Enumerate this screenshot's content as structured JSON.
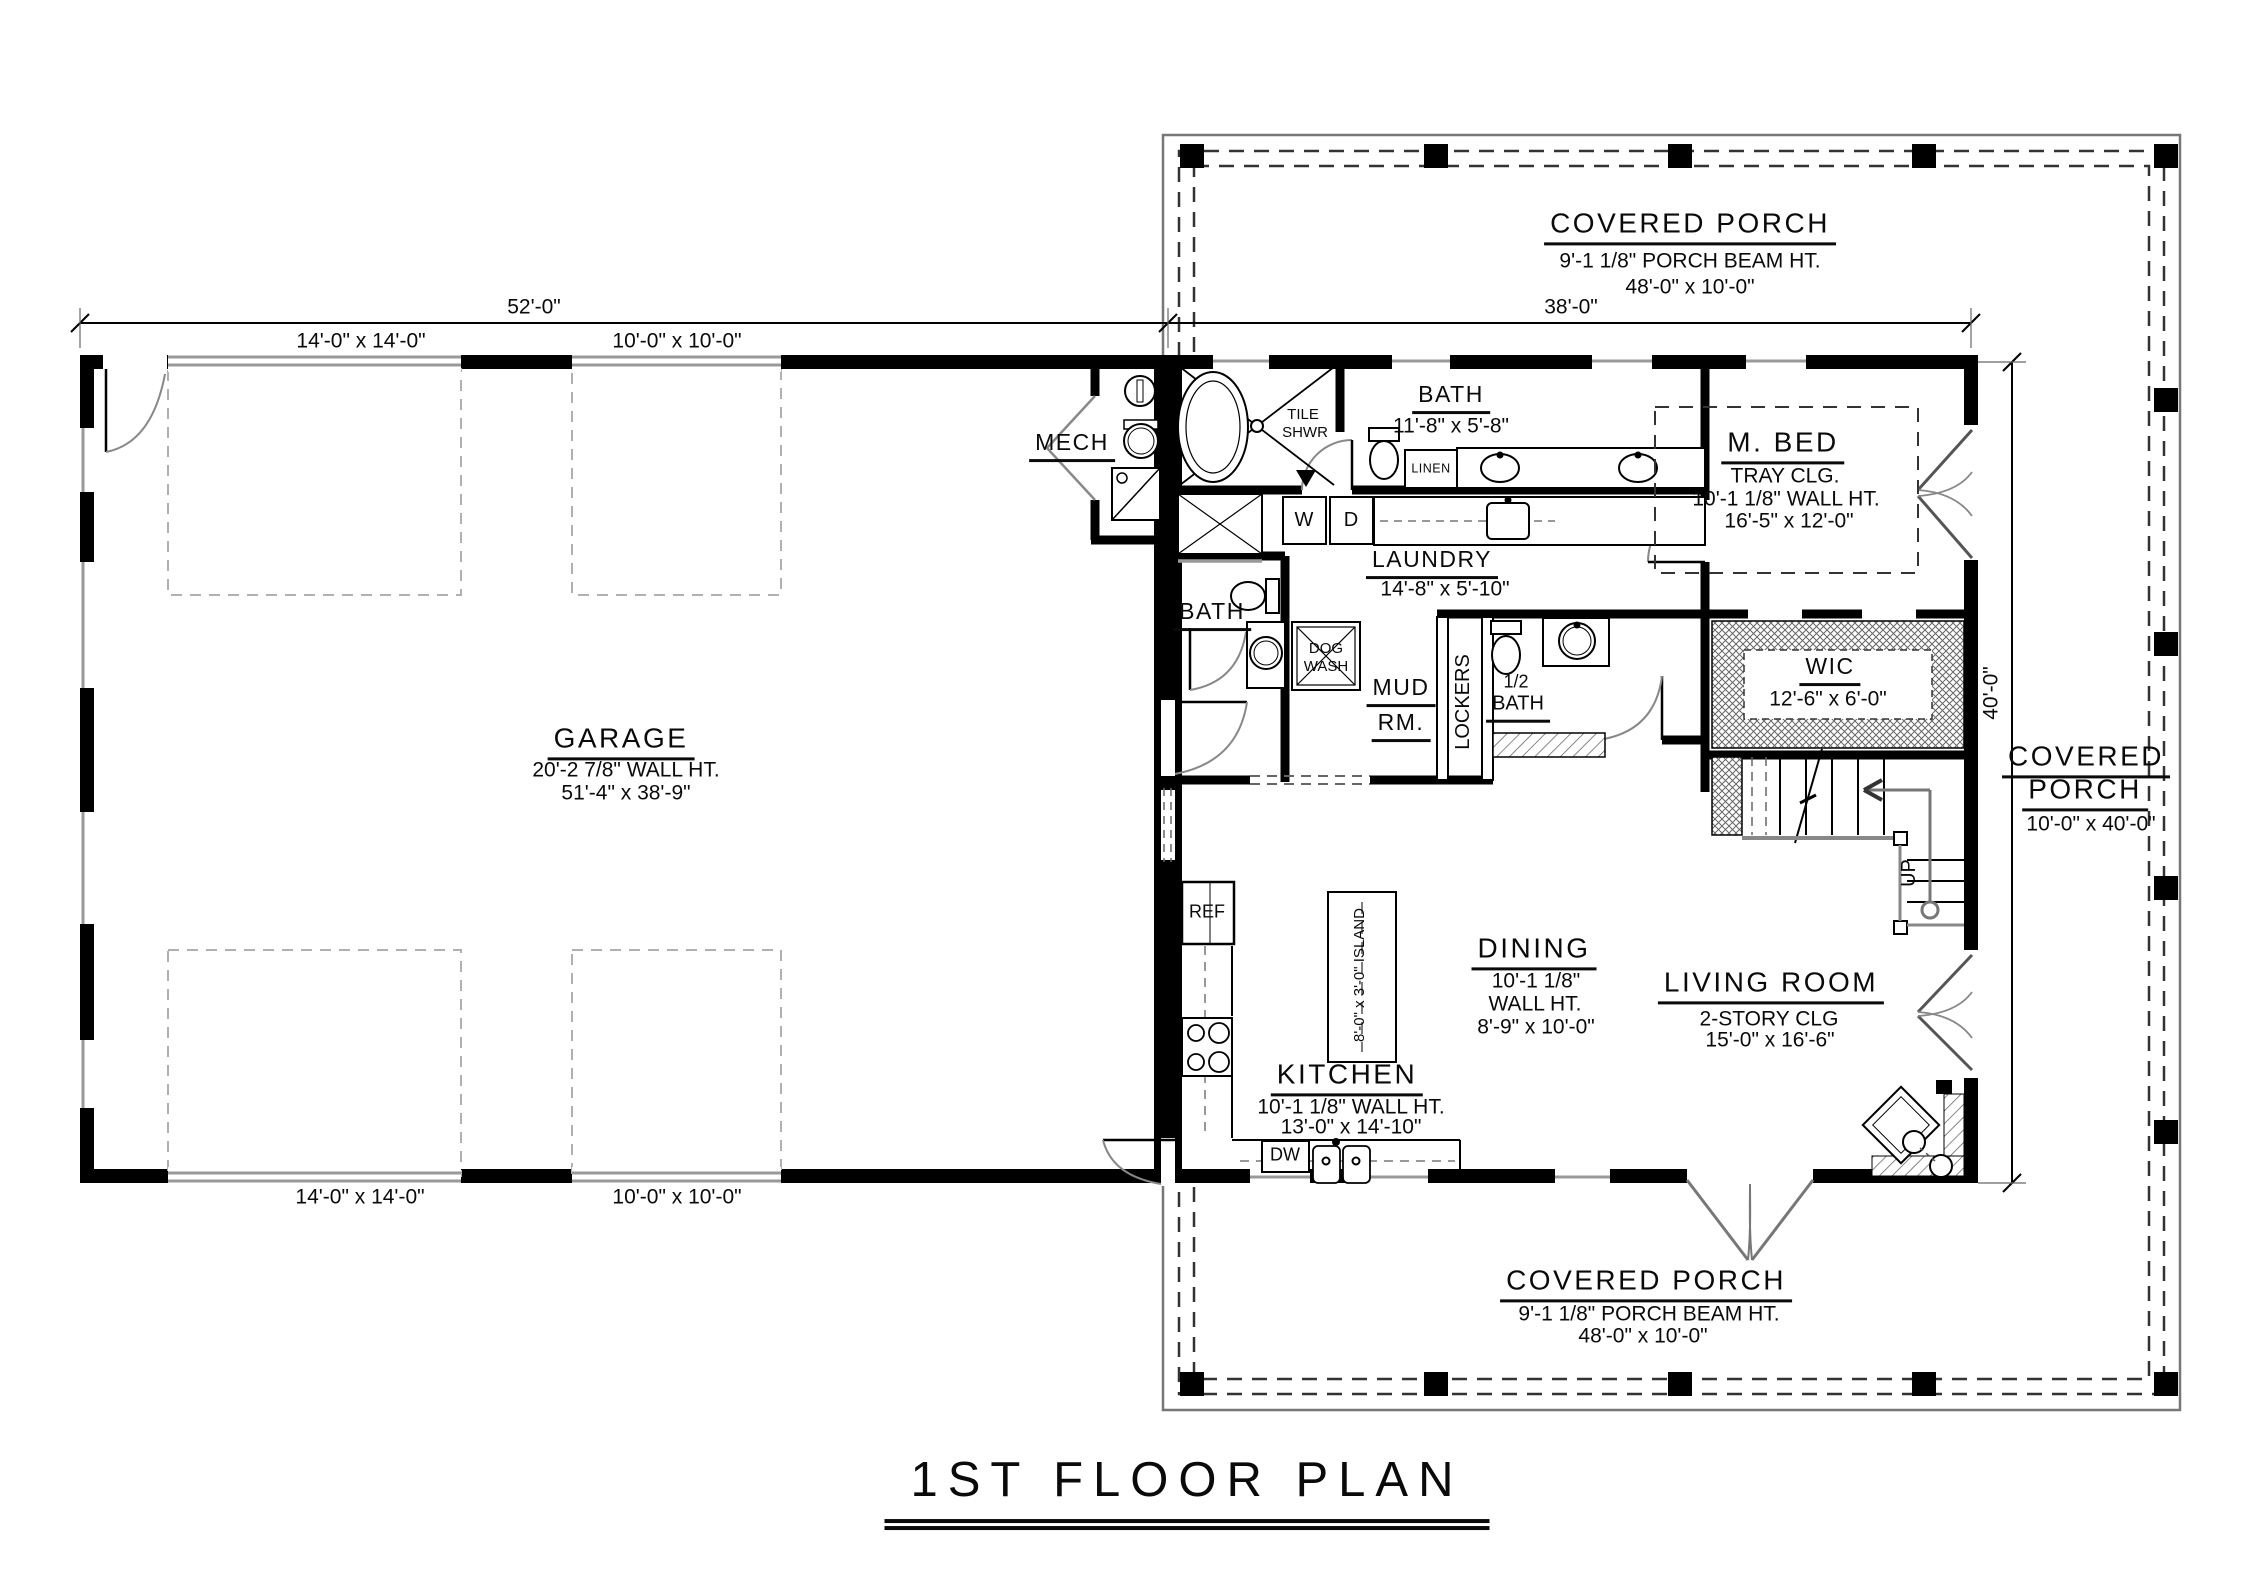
{
  "title": "1ST FLOOR PLAN",
  "dims": {
    "garage_width": "52'-0\"",
    "house_width": "38'-0\"",
    "house_depth": "40'-0\"",
    "garage_door_large_top": "14'-0\" x 14'-0\"",
    "garage_door_small_top": "10'-0\" x 10'-0\"",
    "garage_door_large_bottom": "14'-0\" x 14'-0\"",
    "garage_door_small_bottom": "10'-0\" x 10'-0\""
  },
  "porch_top": {
    "name": "COVERED PORCH",
    "beam_ht": "9'-1 1/8\" PORCH BEAM HT.",
    "size": "48'-0\" x 10'-0\""
  },
  "porch_right": {
    "name1": "COVERED",
    "name2": "PORCH",
    "size": "10'-0\" x 40'-0\""
  },
  "porch_bottom": {
    "name": "COVERED PORCH",
    "beam_ht": "9'-1 1/8\" PORCH BEAM HT.",
    "size": "48'-0\" x 10'-0\""
  },
  "garage": {
    "name": "GARAGE",
    "wall_ht": "20'-2 7/8\" WALL HT.",
    "size": "51'-4\" x 38'-9\""
  },
  "mech": {
    "name": "MECH"
  },
  "master_bath": {
    "name": "BATH",
    "size": "11'-8\" x 5'-8\"",
    "shower1": "TILE",
    "shower2": "SHWR",
    "linen": "LINEN"
  },
  "laundry": {
    "name": "LAUNDRY",
    "size": "14'-8\" x 5'-10\"",
    "washer": "W",
    "dryer": "D"
  },
  "master_bed": {
    "name": "M. BED",
    "ceiling": "TRAY CLG.",
    "wall_ht": "10'-1 1/8\" WALL HT.",
    "size": "16'-5\" x 12'-0\""
  },
  "bath2": {
    "name": "BATH"
  },
  "dog_wash": {
    "line1": "DOG",
    "line2": "WASH"
  },
  "mud_room": {
    "line1": "MUD",
    "line2": "RM."
  },
  "lockers": {
    "name": "LOCKERS"
  },
  "half_bath": {
    "line1": "1/2",
    "line2": "BATH"
  },
  "wic": {
    "name": "WIC",
    "size": "12'-6\" x 6'-0\""
  },
  "stairs": {
    "up": "UP"
  },
  "kitchen": {
    "name": "KITCHEN",
    "wall_ht": "10'-1 1/8\" WALL HT.",
    "size": "13'-0\" x 14'-10\"",
    "ref": "REF",
    "dw": "DW",
    "island": "8'-0\" x 3'-0\" ISLAND"
  },
  "dining": {
    "name": "DINING",
    "wall_ht1": "10'-1 1/8\"",
    "wall_ht2": "WALL HT.",
    "size": "8'-9\" x 10'-0\""
  },
  "living": {
    "name": "LIVING ROOM",
    "ceiling": "2-STORY CLG",
    "size": "15'-0\" x 16'-6\""
  }
}
